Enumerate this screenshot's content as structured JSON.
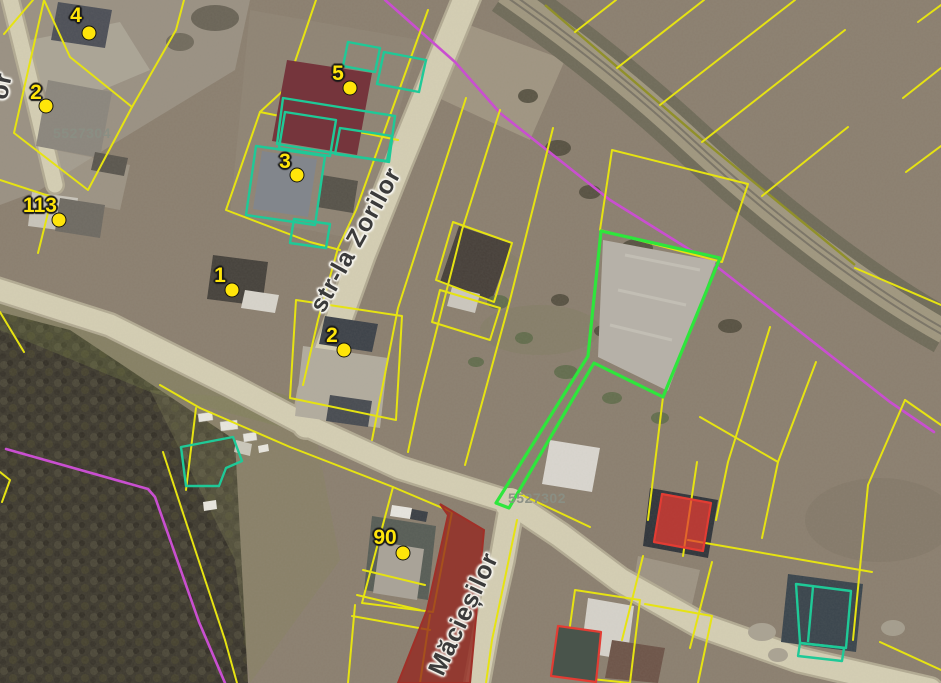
{
  "app": {
    "view": "cadastral-aerial-map"
  },
  "map": {
    "street_labels": [
      {
        "text": "str-la Zorilor"
      },
      {
        "text": "Măcieșilor"
      },
      {
        "text": "or"
      }
    ],
    "parcel_labels": [
      {
        "text": "5527304"
      },
      {
        "text": "5527302"
      }
    ],
    "markers": [
      {
        "label": "4"
      },
      {
        "label": "2"
      },
      {
        "label": "113"
      },
      {
        "label": "1"
      },
      {
        "label": "5"
      },
      {
        "label": "3"
      },
      {
        "label": "2"
      },
      {
        "label": "90"
      }
    ],
    "colors": {
      "parcel_boundary_yellow": "#e6e312",
      "zone_boundary_magenta": "#c94fd0",
      "selected_parcel_green": "#2ee63c",
      "building_outline_teal": "#1fc997",
      "highlight_red": "#e23c33",
      "highlight_red_fill": "#94261f",
      "marker_yellow": "#ffe50a",
      "road_fill": "#d5cfb4",
      "street_label_color": "#3b3b3b",
      "cadastral_label_color": "#8a8f84"
    }
  }
}
